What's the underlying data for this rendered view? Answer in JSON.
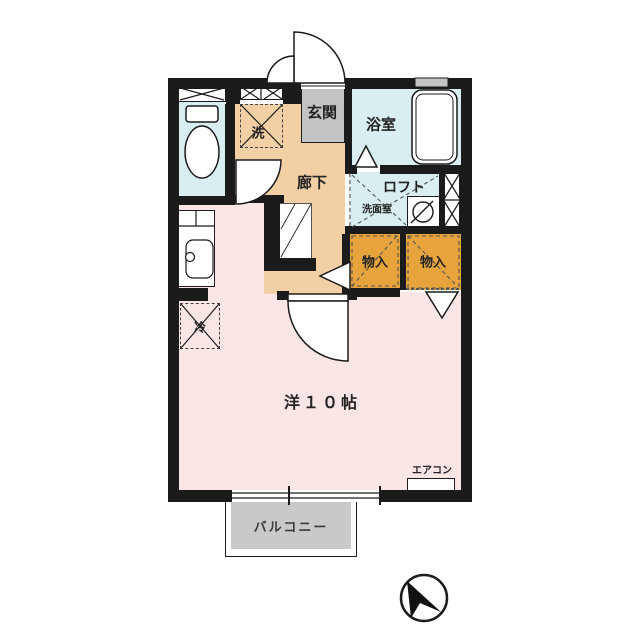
{
  "colors": {
    "wall": "#1b1b1b",
    "water": "#d9eef1",
    "hallway": "#f2cfa4",
    "room": "#fbe5e5",
    "storage": "#e7a43c",
    "entrance": "#c3c3c3",
    "balcony": "#c9c9c9",
    "label": "#222222"
  },
  "labels": {
    "entrance": "玄関",
    "bathroom": "浴室",
    "hallway": "廊下",
    "loft": "ロフト",
    "washroom": "洗面室",
    "washer": "洗",
    "storage_left": "物入",
    "storage_right": "物入",
    "fridge": "冷",
    "main_room": "洋１０帖",
    "aircon": "エアコン",
    "balcony": "バルコニー"
  }
}
